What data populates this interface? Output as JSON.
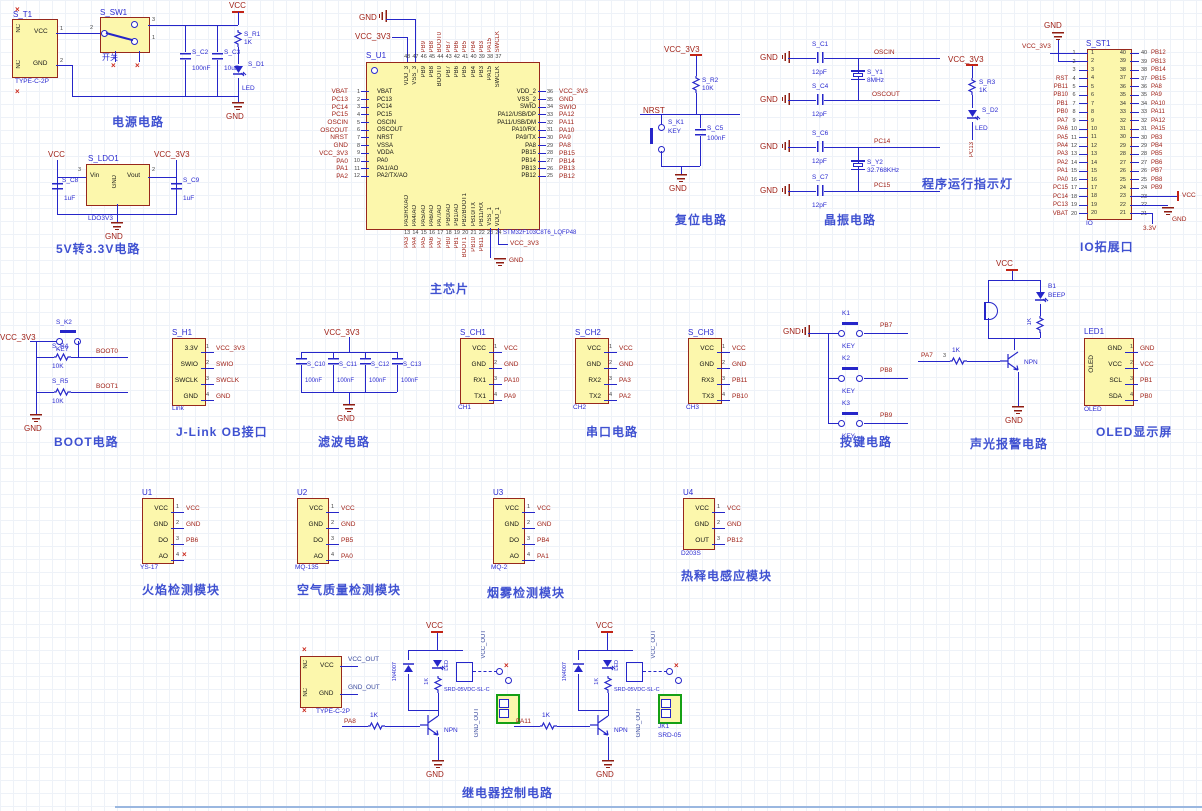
{
  "misc": {
    "x": "×"
  },
  "nets": {
    "vcc": "VCC",
    "gnd": "GND",
    "v33": "VCC_3V3",
    "v3_3": "3.3V",
    "nrst": "NRST",
    "oscin": "OSCIN",
    "oscout": "OSCOUT",
    "pc13": "PC13",
    "pc14": "PC14",
    "pc15": "PC15",
    "boot0": "BOOT0",
    "boot1": "BOOT1"
  },
  "captions": {
    "power": "电源电路",
    "ldo": "5V转3.3V电路",
    "mcu": "主芯片",
    "reset": "复位电路",
    "crystal": "晶振电路",
    "runled": "程序运行指示灯",
    "io": "IO拓展口",
    "boot": "BOOT电路",
    "jlink": "J-Link OB接口",
    "filter": "滤波电路",
    "uart": "串口电路",
    "keys": "按键电路",
    "alarm": "声光报警电路",
    "oled": "OLED显示屏",
    "relay": "继电器控制电路"
  },
  "power": {
    "t1": {
      "ref": "S_T1",
      "part": "TYPE-C-2P",
      "nc": "NC",
      "vcc": "VCC",
      "gnd": "GND",
      "n1": "1",
      "n2": "2"
    },
    "sw": {
      "ref": "S_SW1",
      "label": "开关",
      "p2": "2",
      "p3": "3",
      "p1": "1"
    },
    "c2": {
      "r": "S_C2",
      "v": "100nF"
    },
    "c3": {
      "r": "S_C3",
      "v": "10uF"
    },
    "r1": {
      "r": "S_R1",
      "v": "1K"
    },
    "d1": {
      "r": "S_D1",
      "v": "LED"
    }
  },
  "ldo": {
    "ref": "S_LDO1",
    "part": "LDO3V3",
    "vin": "Vin",
    "vout": "Vout",
    "gnd": "GND",
    "n3": "3",
    "n2": "2",
    "c8": {
      "r": "S_C8",
      "v": "1uF"
    },
    "c9": {
      "r": "S_C9",
      "v": "1uF"
    }
  },
  "mcu": {
    "ref": "S_U1",
    "part": "STM32F103C8T6_LQFP48",
    "top": [
      {
        "n": "48",
        "name": "VDD_3",
        "net": ""
      },
      {
        "n": "47",
        "name": "VSS_3",
        "net": ""
      },
      {
        "n": "46",
        "name": "PB9",
        "net": "PB9"
      },
      {
        "n": "45",
        "name": "PB8",
        "net": "PB8"
      },
      {
        "n": "44",
        "name": "BOOT0",
        "net": "BOOT0"
      },
      {
        "n": "43",
        "name": "PB7",
        "net": "PB7"
      },
      {
        "n": "42",
        "name": "PB6",
        "net": "PB6"
      },
      {
        "n": "41",
        "name": "PB5",
        "net": "PB5"
      },
      {
        "n": "40",
        "name": "PB4",
        "net": "PB4"
      },
      {
        "n": "39",
        "name": "PB3",
        "net": "PB3"
      },
      {
        "n": "38",
        "name": "PA15",
        "net": "PA15"
      },
      {
        "n": "37",
        "name": "SWCLK",
        "net": "SWCLK"
      }
    ],
    "left": [
      {
        "n": "1",
        "name": "VBAT",
        "net": "VBAT"
      },
      {
        "n": "2",
        "name": "PC13",
        "net": "PC13"
      },
      {
        "n": "3",
        "name": "PC14",
        "net": "PC14"
      },
      {
        "n": "4",
        "name": "PC15",
        "net": "PC15"
      },
      {
        "n": "5",
        "name": "OSCIN",
        "net": "OSCIN"
      },
      {
        "n": "6",
        "name": "OSCOUT",
        "net": "OSCOUT"
      },
      {
        "n": "7",
        "name": "NRST",
        "net": "NRST"
      },
      {
        "n": "8",
        "name": "VSSA",
        "net": "GND"
      },
      {
        "n": "9",
        "name": "VDDA",
        "net": "VCC_3V3"
      },
      {
        "n": "10",
        "name": "PA0",
        "net": "PA0"
      },
      {
        "n": "11",
        "name": "PA1/AO",
        "net": "PA1"
      },
      {
        "n": "12",
        "name": "PA2/TX/AO",
        "net": "PA2"
      }
    ],
    "right": [
      {
        "n": "36",
        "name": "VDD_2",
        "net": "VCC_3V3"
      },
      {
        "n": "35",
        "name": "VSS_2",
        "net": "GND"
      },
      {
        "n": "34",
        "name": "SWIO",
        "net": "SWIO"
      },
      {
        "n": "33",
        "name": "PA12/USB/DP",
        "net": "PA12"
      },
      {
        "n": "32",
        "name": "PA11/USB/DM",
        "net": "PA11"
      },
      {
        "n": "31",
        "name": "PA10/RX",
        "net": "PA10"
      },
      {
        "n": "30",
        "name": "PA9/TX",
        "net": "PA9"
      },
      {
        "n": "29",
        "name": "PA8",
        "net": "PA8"
      },
      {
        "n": "28",
        "name": "PB15",
        "net": "PB15"
      },
      {
        "n": "27",
        "name": "PB14",
        "net": "PB14"
      },
      {
        "n": "26",
        "name": "PB13",
        "net": "PB13"
      },
      {
        "n": "25",
        "name": "PB12",
        "net": "PB12"
      }
    ],
    "bottom": [
      {
        "n": "13",
        "name": "PA3/RX/AO",
        "net": "PA3"
      },
      {
        "n": "14",
        "name": "PA4/AO",
        "net": "PA4"
      },
      {
        "n": "15",
        "name": "PA5/AO",
        "net": "PA5"
      },
      {
        "n": "16",
        "name": "PA6/AO",
        "net": "PA6"
      },
      {
        "n": "17",
        "name": "PA7/AO",
        "net": "PA7"
      },
      {
        "n": "18",
        "name": "PB0/AO",
        "net": "PB0"
      },
      {
        "n": "19",
        "name": "PB1/AO",
        "net": "PB1"
      },
      {
        "n": "20",
        "name": "PB2/BOOT1",
        "net": "BOOT1"
      },
      {
        "n": "21",
        "name": "PB10/TX",
        "net": "PB10"
      },
      {
        "n": "22",
        "name": "PB11/RX",
        "net": "PB11"
      },
      {
        "n": "23",
        "name": "VSS_1",
        "net": ""
      },
      {
        "n": "24",
        "name": "VDD_1",
        "net": ""
      }
    ]
  },
  "reset": {
    "r2": {
      "r": "S_R2",
      "v": "10K"
    },
    "k1": {
      "r": "S_K1",
      "v": "KEY"
    },
    "c5": {
      "r": "S_C5",
      "v": "100nF"
    }
  },
  "crystal": {
    "c1": {
      "r": "S_C1",
      "v": "12pF"
    },
    "c4": {
      "r": "S_C4",
      "v": "12pF"
    },
    "c6": {
      "r": "S_C6",
      "v": "12pF"
    },
    "c7": {
      "r": "S_C7",
      "v": "12pF"
    },
    "y1": {
      "r": "S_Y1",
      "v": "8MHz"
    },
    "y2": {
      "r": "S_Y2",
      "v": "32.768KHz"
    }
  },
  "runled": {
    "r3": {
      "r": "S_R3",
      "v": "1K"
    },
    "d2": {
      "r": "S_D2",
      "v": "LED"
    }
  },
  "io": {
    "ref": "S_ST1",
    "part": "IO",
    "left": [
      {
        "n": "1",
        "net": ""
      },
      {
        "n": "2",
        "net": ""
      },
      {
        "n": "3",
        "net": ""
      },
      {
        "n": "4",
        "net": "RST"
      },
      {
        "n": "5",
        "net": "PB11"
      },
      {
        "n": "6",
        "net": "PB10"
      },
      {
        "n": "7",
        "net": "PB1"
      },
      {
        "n": "8",
        "net": "PB0"
      },
      {
        "n": "9",
        "net": "PA7"
      },
      {
        "n": "10",
        "net": "PA6"
      },
      {
        "n": "11",
        "net": "PA5"
      },
      {
        "n": "12",
        "net": "PA4"
      },
      {
        "n": "13",
        "net": "PA3"
      },
      {
        "n": "14",
        "net": "PA2"
      },
      {
        "n": "15",
        "net": "PA1"
      },
      {
        "n": "16",
        "net": "PA0"
      },
      {
        "n": "17",
        "net": "PC15"
      },
      {
        "n": "18",
        "net": "PC14"
      },
      {
        "n": "19",
        "net": "PC13"
      },
      {
        "n": "20",
        "net": "VBAT"
      }
    ],
    "right": [
      {
        "n": "40",
        "net": "PB12"
      },
      {
        "n": "39",
        "net": "PB13"
      },
      {
        "n": "38",
        "net": "PB14"
      },
      {
        "n": "37",
        "net": "PB15"
      },
      {
        "n": "36",
        "net": "PA8"
      },
      {
        "n": "35",
        "net": "PA9"
      },
      {
        "n": "34",
        "net": "PA10"
      },
      {
        "n": "33",
        "net": "PA11"
      },
      {
        "n": "32",
        "net": "PA12"
      },
      {
        "n": "31",
        "net": "PA15"
      },
      {
        "n": "30",
        "net": "PB3"
      },
      {
        "n": "29",
        "net": "PB4"
      },
      {
        "n": "28",
        "net": "PB5"
      },
      {
        "n": "27",
        "net": "PB6"
      },
      {
        "n": "26",
        "net": "PB7"
      },
      {
        "n": "25",
        "net": "PB8"
      },
      {
        "n": "24",
        "net": "PB9"
      },
      {
        "n": "23",
        "net": ""
      },
      {
        "n": "22",
        "net": ""
      },
      {
        "n": "21",
        "net": ""
      }
    ]
  },
  "boot": {
    "k2": {
      "r": "S_K2",
      "v": "KEY"
    },
    "r4": {
      "r": "S_R4",
      "v": "10K"
    },
    "r5": {
      "r": "S_R5",
      "v": "10K"
    }
  },
  "jlink": {
    "ref": "S_H1",
    "part": "Link",
    "rows": [
      {
        "name": "3.3V",
        "n": "1",
        "net": "VCC_3V3"
      },
      {
        "name": "SWIO",
        "n": "2",
        "net": "SWIO"
      },
      {
        "name": "SWCLK",
        "n": "3",
        "net": "SWCLK"
      },
      {
        "name": "GND",
        "n": "4",
        "net": "GND"
      }
    ]
  },
  "filter": {
    "caps": [
      {
        "r": "S_C10",
        "v": "100nF"
      },
      {
        "r": "S_C11",
        "v": "100nF"
      },
      {
        "r": "S_C12",
        "v": "100nF"
      },
      {
        "r": "S_C13",
        "v": "100nF"
      }
    ]
  },
  "uart": {
    "modules": [
      {
        "ref": "S_CH1",
        "part": "CH1",
        "rows": [
          {
            "name": "VCC",
            "n": "1",
            "net": "VCC"
          },
          {
            "name": "GND",
            "n": "2",
            "net": "GND"
          },
          {
            "name": "RX1",
            "n": "3",
            "net": "PA10"
          },
          {
            "name": "TX1",
            "n": "4",
            "net": "PA9"
          }
        ]
      },
      {
        "ref": "S_CH2",
        "part": "CH2",
        "rows": [
          {
            "name": "VCC",
            "n": "1",
            "net": "VCC"
          },
          {
            "name": "GND",
            "n": "2",
            "net": "GND"
          },
          {
            "name": "RX2",
            "n": "3",
            "net": "PA3"
          },
          {
            "name": "TX2",
            "n": "4",
            "net": "PA2"
          }
        ]
      },
      {
        "ref": "S_CH3",
        "part": "CH3",
        "rows": [
          {
            "name": "VCC",
            "n": "1",
            "net": "VCC"
          },
          {
            "name": "GND",
            "n": "2",
            "net": "GND"
          },
          {
            "name": "RX3",
            "n": "3",
            "net": "PB11"
          },
          {
            "name": "TX3",
            "n": "4",
            "net": "PB10"
          }
        ]
      }
    ]
  },
  "keys": {
    "items": [
      {
        "ref": "K1",
        "label": "KEY",
        "net": "PB7"
      },
      {
        "ref": "K2",
        "label": "KEY",
        "net": "PB8"
      },
      {
        "ref": "K3",
        "label": "KEY",
        "net": "PB9"
      }
    ]
  },
  "alarm": {
    "ref": "B1",
    "part": "BEEP",
    "r_top": "1K",
    "npn": "NPN",
    "trigger": "PA7",
    "pin": "3",
    "r_base": "1K"
  },
  "oled": {
    "ref": "LED1",
    "part": "OLED",
    "inner": "OLED",
    "rows": [
      {
        "name": "GND",
        "n": "1",
        "net": "GND"
      },
      {
        "name": "VCC",
        "n": "2",
        "net": "VCC"
      },
      {
        "name": "SCL",
        "n": "3",
        "net": "PB1"
      },
      {
        "name": "SDA",
        "n": "4",
        "net": "PB0"
      }
    ]
  },
  "sensors": [
    {
      "ref": "U1",
      "part": "YS-17",
      "caption": "火焰检测模块",
      "rows": [
        {
          "name": "VCC",
          "n": "1",
          "net": "VCC"
        },
        {
          "name": "GND",
          "n": "2",
          "net": "GND"
        },
        {
          "name": "DO",
          "n": "3",
          "net": "PB6"
        },
        {
          "name": "AO",
          "n": "4",
          "net": ""
        }
      ]
    },
    {
      "ref": "U2",
      "part": "MQ-135",
      "caption": "空气质量检测模块",
      "rows": [
        {
          "name": "VCC",
          "n": "1",
          "net": "VCC"
        },
        {
          "name": "GND",
          "n": "2",
          "net": "GND"
        },
        {
          "name": "DO",
          "n": "3",
          "net": "PB5"
        },
        {
          "name": "AO",
          "n": "4",
          "net": "PA0"
        }
      ]
    },
    {
      "ref": "U3",
      "part": "MQ-2",
      "caption": "烟雾检测模块",
      "rows": [
        {
          "name": "VCC",
          "n": "1",
          "net": "VCC"
        },
        {
          "name": "GND",
          "n": "2",
          "net": "GND"
        },
        {
          "name": "DO",
          "n": "3",
          "net": "PB4"
        },
        {
          "name": "AO",
          "n": "4",
          "net": "PA1"
        }
      ]
    },
    {
      "ref": "U4",
      "part": "D203S",
      "caption": "热释电感应模块",
      "rows": [
        {
          "name": "VCC",
          "n": "1",
          "net": "VCC"
        },
        {
          "name": "GND",
          "n": "2",
          "net": "GND"
        },
        {
          "name": "OUT",
          "n": "3",
          "net": "PB12"
        }
      ]
    }
  ],
  "relay": {
    "tc": {
      "part": "TYPE-C-2P",
      "nc": "NC",
      "vcc": "VCC",
      "gnd": "GND"
    },
    "vcc_out": "VCC_OUT",
    "gnd_out": "GND_OUT",
    "diode": "1N4007",
    "led": "LED",
    "coil_r": "1K",
    "relay_part": "SRD-05VDC-SL-C",
    "npn": "NPN",
    "a": {
      "trigger": "PA8",
      "r": "1K"
    },
    "b": {
      "trigger": "PA11",
      "r": "1K"
    },
    "jk": {
      "ref": "JK1",
      "part": "SRD-05"
    }
  }
}
